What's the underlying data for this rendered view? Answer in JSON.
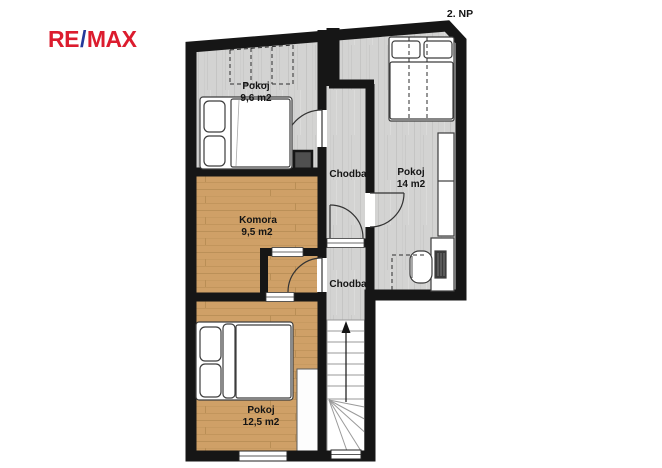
{
  "floor_label": "2. NP",
  "logo": {
    "re": "RE",
    "slash": "/",
    "max": "MAX",
    "red": "#dc1c2e",
    "blue": "#24399b"
  },
  "plan": {
    "rooms": {
      "pokoj_top_left": {
        "name": "Pokoj",
        "area": "9,6 m2"
      },
      "pokoj_right": {
        "name": "Pokoj",
        "area": "14 m2"
      },
      "chodba_upper": {
        "name": "Chodba"
      },
      "komora": {
        "name": "Komora",
        "area": "9,5 m2"
      },
      "chodba_lower": {
        "name": "Chodba"
      },
      "pokoj_bottom": {
        "name": "Pokoj",
        "area": "12,5 m2"
      }
    }
  },
  "colors": {
    "wall": "#161616",
    "floor_wood": "#cfa067",
    "floor_gray": "#d3d3d2",
    "furniture_outline": "#3d3d3d",
    "chimney_fill": "#4f4f4f",
    "background": "#ffffff"
  }
}
